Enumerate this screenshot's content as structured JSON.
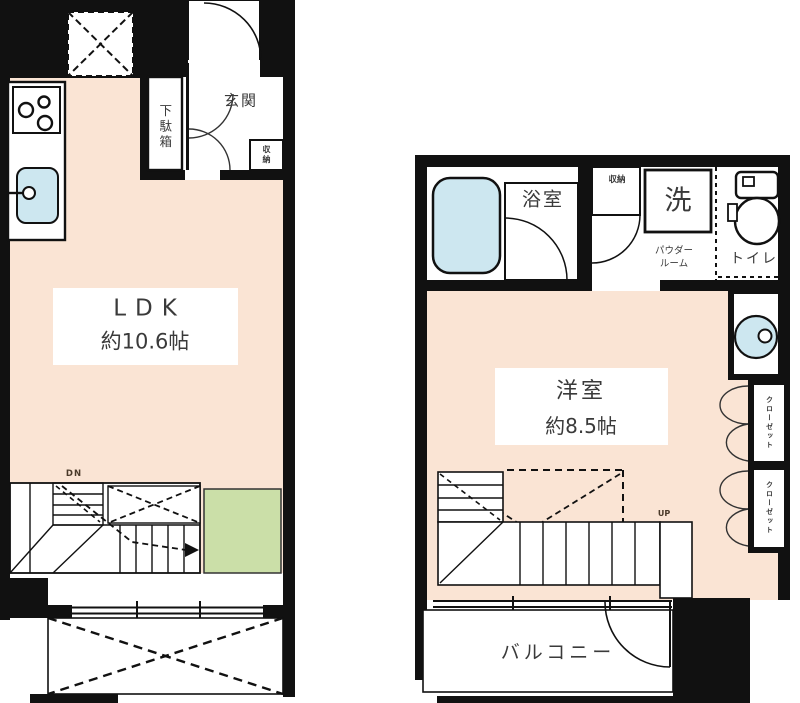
{
  "plan": {
    "upper": {
      "ldk_name": "LDK",
      "ldk_size": "約10.6帖",
      "entrance": "玄関",
      "shoe_cabinet": "下駄箱",
      "storage": "収納",
      "stairs": "DN"
    },
    "lower": {
      "western_room_name": "洋室",
      "western_room_size": "約8.5帖",
      "bathroom": "浴室",
      "storage": "収納",
      "laundry": "洗",
      "powder_room_1": "パウダー",
      "powder_room_2": "ルーム",
      "toilet": "トイレ",
      "closet_1": "クローゼット",
      "closet_2": "クローゼット",
      "stairs": "UP",
      "balcony": "バルコニー"
    }
  },
  "colors": {
    "wall": "#111111",
    "floor": "#FAE4D4",
    "tatami_green": "#CBDFA8",
    "water_blue": "#CDE7F0"
  }
}
